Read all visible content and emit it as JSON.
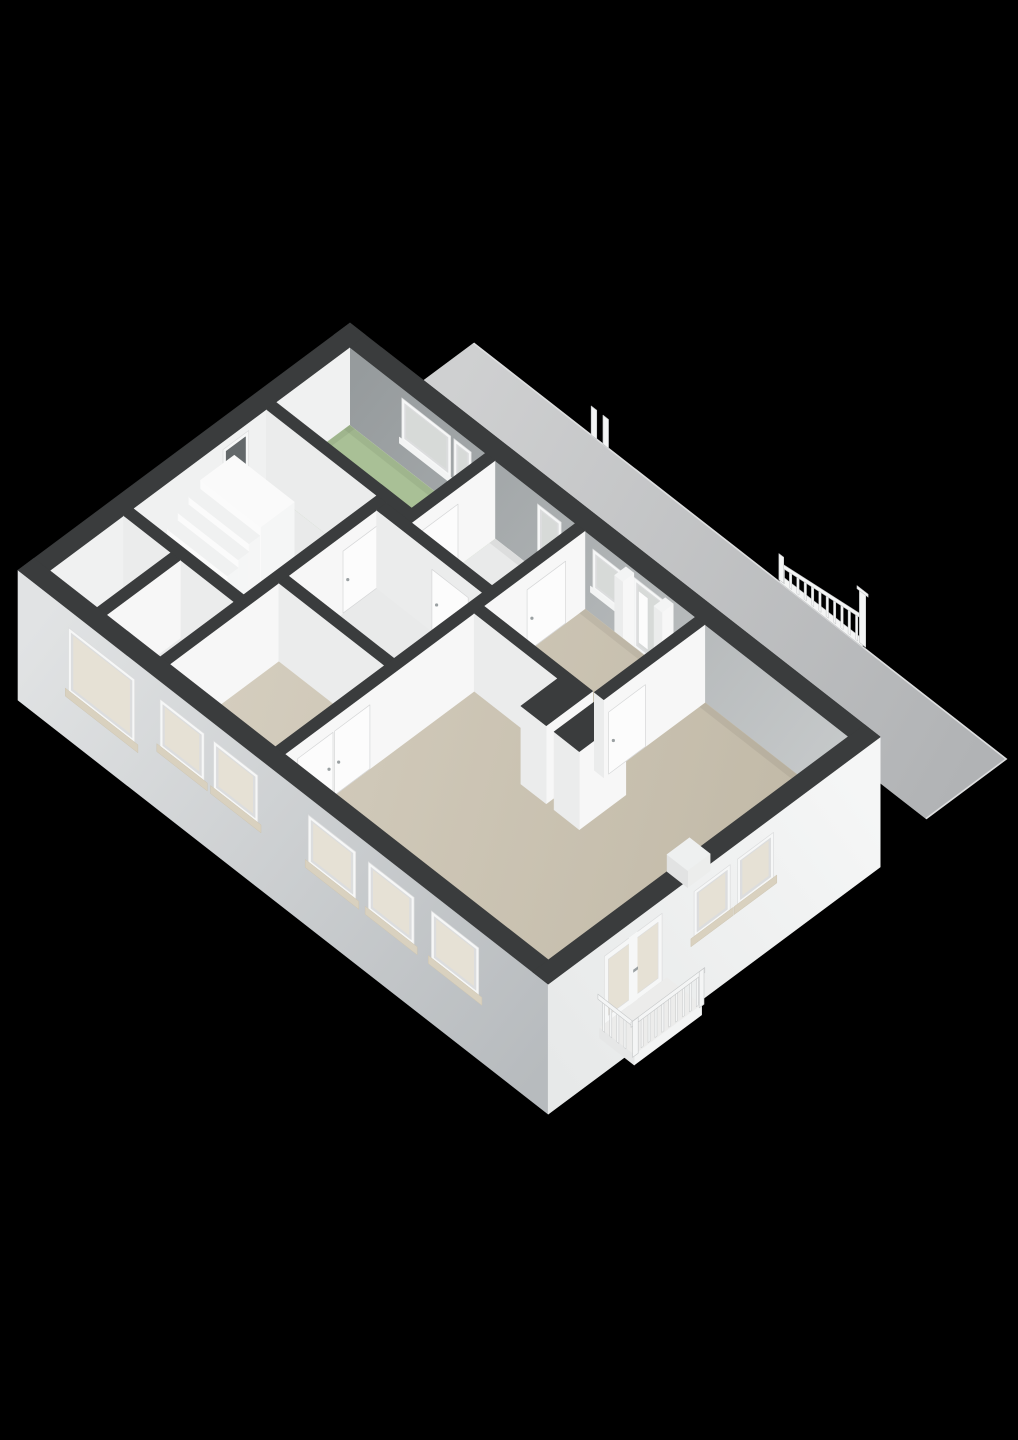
{
  "scene": {
    "background": "#000000",
    "colors": {
      "wallCap": "#3a3c3d",
      "wallOuterShadow": "#2f3132",
      "faceSE": "#f7f7f7",
      "faceSW": "#ebecec",
      "neInner1": "#969b9d",
      "neInner2": "#c7cacb",
      "nwInner": "#f0f1f1",
      "floorHall": "#e9eaea",
      "floorBath": "#a9c096",
      "floorBeige1": "#d5cebf",
      "floorBeige2": "#c2baa8",
      "facadeSW1": "#e1e3e4",
      "facadeSW2": "#b7bbbe",
      "facadeSE1": "#e7e9e9",
      "facadeSE2": "#f5f6f6",
      "terrace1": "#cfd0d1",
      "terrace2": "#b1b3b5",
      "terraceEdge": "#dddedf",
      "frame": "#f6f7f7",
      "frameShade": "#dcddde",
      "glassWarm": "#e6e1d5",
      "glassCool": "#d7dad8",
      "glassDark": "#63686a",
      "sill": "#d9d1bf",
      "door": "#fcfcfc",
      "doorEdge": "#d6d7d8",
      "handle": "#9aa0a2",
      "railing": "#f4f5f5",
      "railingEdge": "#c6c8c9",
      "stairTread": "#f0f1f1",
      "stairRiser": "#fbfbfb",
      "stairSide": "#f5f6f6",
      "white": "#f3f4f4",
      "slab": "#ececeb",
      "fascia": "#e6e7e7",
      "vanityTop": "#fafafa",
      "vanitySide": "#eeefef",
      "ao": "rgba(0,0,0,0.055)"
    },
    "elements": {
      "terrace": "roof-terrace",
      "railing": "terrace-railing",
      "bathroom": "bathroom-green-floor",
      "hall": "hallway-floor",
      "stairs": "staircase",
      "bedroom": "bedroom-floor",
      "living": "living-room-floor",
      "balcony": "french-balcony",
      "houseShell": "outer-walls"
    }
  }
}
